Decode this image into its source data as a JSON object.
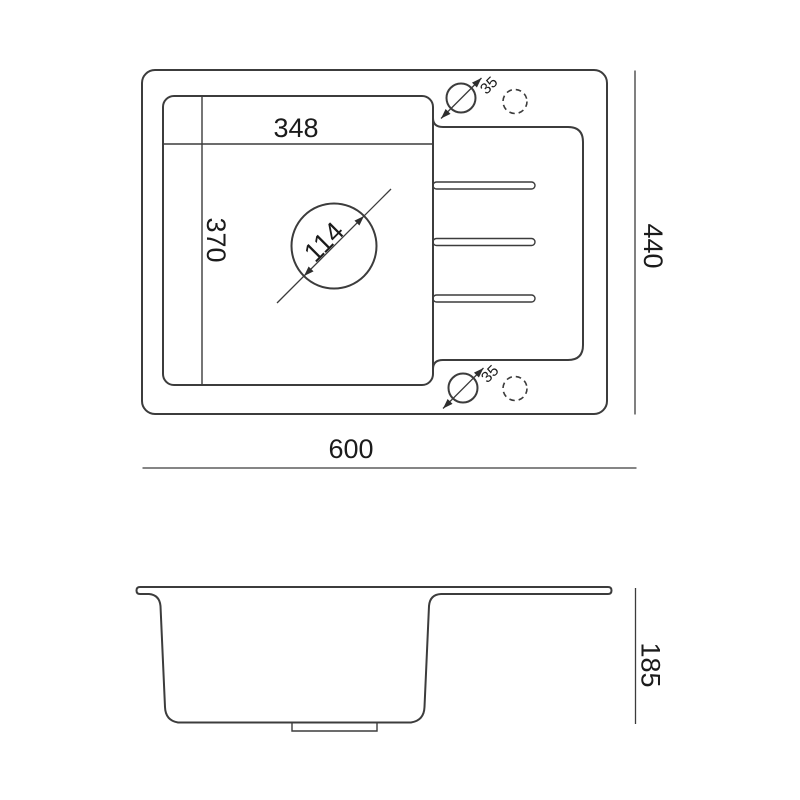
{
  "drawing": {
    "top_view": {
      "bowl_width_mm": "348",
      "bowl_depth_mm": "370",
      "drain_diameter_mm": "114",
      "tap_hole_top_mm": "35",
      "tap_hole_bottom_mm": "35",
      "overall_width_mm": "600",
      "overall_depth_mm": "440"
    },
    "side_view": {
      "overall_height_mm": "185"
    },
    "colors": {
      "background": "#ffffff",
      "line": "#3c3c3c",
      "text": "#1b1b1b"
    }
  }
}
